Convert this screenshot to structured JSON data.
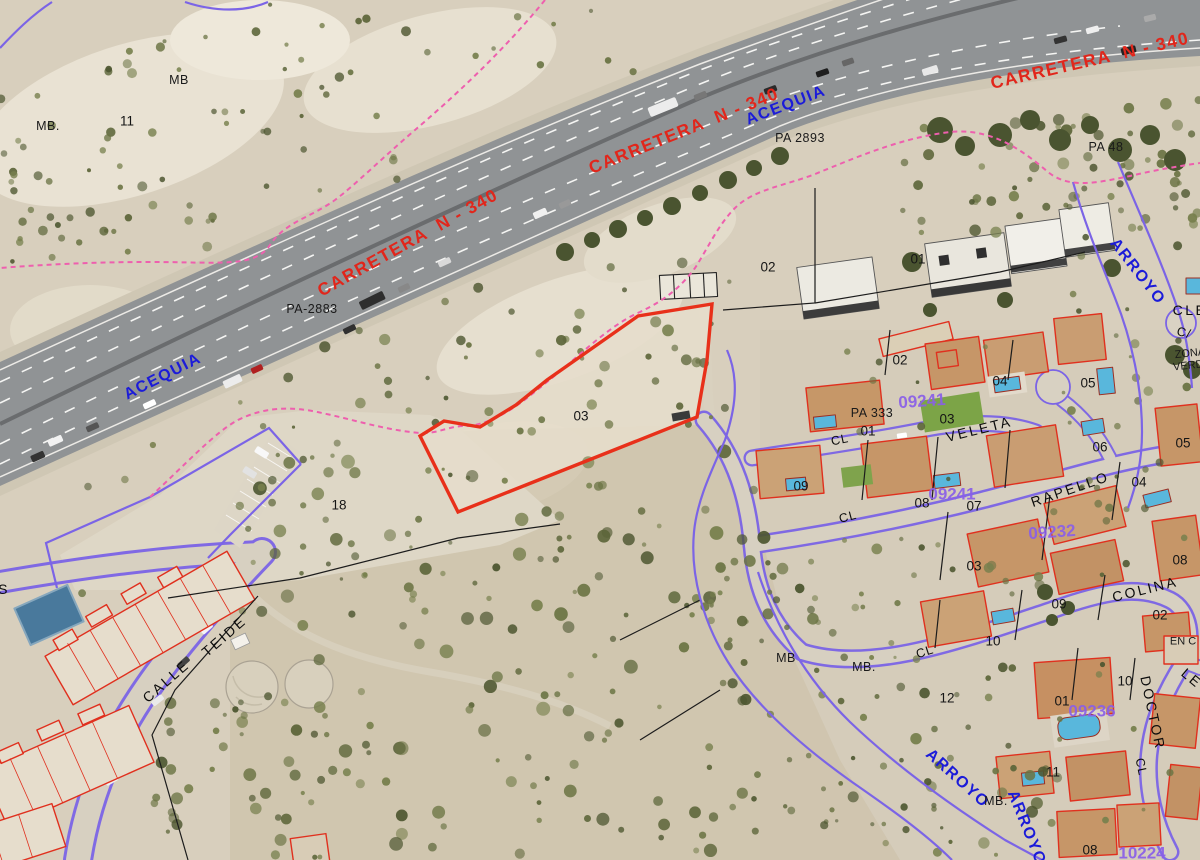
{
  "map": {
    "type": "cadastral-orthophoto",
    "highlighted_parcel": {
      "number": "03",
      "outline_color": "#e8301a"
    },
    "colors": {
      "road_label_red": "#e1261b",
      "hydro_label_blue": "#1b1bd9",
      "block_label_violet": "#8a5fe8",
      "cadastral_building_red": "#e0301e",
      "boundary_purple": "#7b64e6",
      "boundary_pink_dashed": "#ee5fae",
      "pool_blue": "#59b7dc"
    },
    "labels": [
      {
        "text": "CARRETERA  N - 340",
        "x": 408,
        "y": 243,
        "rot": -29,
        "cls": "carretera"
      },
      {
        "text": "CARRETERA  N - 340",
        "x": 684,
        "y": 131,
        "rot": -22,
        "cls": "carretera"
      },
      {
        "text": "CARRETERA  N - 340",
        "x": 1090,
        "y": 61,
        "rot": -13,
        "cls": "carretera"
      },
      {
        "text": "ACEQUIA",
        "x": 163,
        "y": 377,
        "rot": -27,
        "cls": "agua"
      },
      {
        "text": "ACEQUIA",
        "x": 786,
        "y": 106,
        "rot": -21,
        "cls": "agua"
      },
      {
        "text": "ARROYO",
        "x": 1137,
        "y": 272,
        "rot": 52,
        "cls": "agua"
      },
      {
        "text": "ARROYO",
        "x": 957,
        "y": 779,
        "rot": 42,
        "cls": "agua"
      },
      {
        "text": "ARROYO",
        "x": 1026,
        "y": 828,
        "rot": 68,
        "cls": "agua"
      },
      {
        "text": "09241",
        "x": 922,
        "y": 401,
        "rot": -4,
        "cls": "manzana"
      },
      {
        "text": "09241",
        "x": 952,
        "y": 494,
        "rot": 0,
        "cls": "manzana"
      },
      {
        "text": "09232",
        "x": 1052,
        "y": 532,
        "rot": -4,
        "cls": "manzana"
      },
      {
        "text": "09236",
        "x": 1092,
        "y": 711,
        "rot": 0,
        "cls": "manzana"
      },
      {
        "text": "10224",
        "x": 1142,
        "y": 853,
        "rot": 0,
        "cls": "manzana"
      },
      {
        "text": "CALLE",
        "x": 166,
        "y": 681,
        "rot": -41,
        "cls": "street"
      },
      {
        "text": "TEIDE",
        "x": 224,
        "y": 636,
        "rot": -41,
        "cls": "street"
      },
      {
        "text": "VELETA",
        "x": 979,
        "y": 429,
        "rot": -14,
        "cls": "street"
      },
      {
        "text": "RAPELLO",
        "x": 1070,
        "y": 489,
        "rot": -19,
        "cls": "street"
      },
      {
        "text": "COLINA",
        "x": 1145,
        "y": 589,
        "rot": -14,
        "cls": "street"
      },
      {
        "text": "DOCTOR",
        "x": 1153,
        "y": 713,
        "rot": 78,
        "cls": "street"
      },
      {
        "text": "LE",
        "x": 1192,
        "y": 678,
        "rot": 40,
        "cls": "street"
      },
      {
        "text": "CL",
        "x": 840,
        "y": 440,
        "rot": -12,
        "cls": "street-sm"
      },
      {
        "text": "CL",
        "x": 848,
        "y": 517,
        "rot": -15,
        "cls": "street-sm"
      },
      {
        "text": "CL",
        "x": 925,
        "y": 652,
        "rot": -18,
        "cls": "street-sm"
      },
      {
        "text": "CL",
        "x": 1141,
        "y": 767,
        "rot": 78,
        "cls": "street-sm"
      },
      {
        "text": "C/",
        "x": 1184,
        "y": 333,
        "rot": 15,
        "cls": "street-sm"
      },
      {
        "text": "CLE",
        "x": 1190,
        "y": 310,
        "rot": 0,
        "cls": "street"
      },
      {
        "text": "S",
        "x": 4,
        "y": 589,
        "rot": 0,
        "cls": "street"
      },
      {
        "text": "ZONA",
        "x": 1190,
        "y": 354,
        "rot": -6,
        "cls": "small"
      },
      {
        "text": "VERDE",
        "x": 1192,
        "y": 366,
        "rot": -6,
        "cls": "small"
      },
      {
        "text": "EN C",
        "x": 1183,
        "y": 642,
        "rot": 0,
        "cls": "small"
      },
      {
        "text": "PA-2883",
        "x": 312,
        "y": 309,
        "rot": 0,
        "cls": "ref"
      },
      {
        "text": "PA 2893",
        "x": 800,
        "y": 138,
        "rot": 0,
        "cls": "ref"
      },
      {
        "text": "PA 48",
        "x": 1106,
        "y": 147,
        "rot": 0,
        "cls": "ref"
      },
      {
        "text": "PA 333",
        "x": 872,
        "y": 413,
        "rot": 0,
        "cls": "ref"
      },
      {
        "text": "MB.",
        "x": 48,
        "y": 126,
        "rot": 0,
        "cls": "ref"
      },
      {
        "text": "MB",
        "x": 179,
        "y": 80,
        "rot": 0,
        "cls": "ref"
      },
      {
        "text": "MB",
        "x": 786,
        "y": 658,
        "rot": 0,
        "cls": "ref"
      },
      {
        "text": "MB.",
        "x": 864,
        "y": 667,
        "rot": 0,
        "cls": "ref"
      },
      {
        "text": "MB.",
        "x": 996,
        "y": 801,
        "rot": 0,
        "cls": "ref"
      },
      {
        "text": "11",
        "x": 127,
        "y": 121,
        "rot": 0,
        "cls": "num"
      },
      {
        "text": "02",
        "x": 768,
        "y": 267,
        "rot": 0,
        "cls": "num"
      },
      {
        "text": "01",
        "x": 918,
        "y": 259,
        "rot": 0,
        "cls": "num"
      },
      {
        "text": "03",
        "x": 581,
        "y": 416,
        "rot": 0,
        "cls": "num"
      },
      {
        "text": "18",
        "x": 339,
        "y": 505,
        "rot": 0,
        "cls": "num"
      },
      {
        "text": "02",
        "x": 900,
        "y": 360,
        "rot": 0,
        "cls": "num"
      },
      {
        "text": "01",
        "x": 868,
        "y": 431,
        "rot": 0,
        "cls": "num"
      },
      {
        "text": "03",
        "x": 947,
        "y": 419,
        "rot": 0,
        "cls": "num"
      },
      {
        "text": "04",
        "x": 1000,
        "y": 381,
        "rot": 0,
        "cls": "num"
      },
      {
        "text": "05",
        "x": 1088,
        "y": 383,
        "rot": 0,
        "cls": "num"
      },
      {
        "text": "09",
        "x": 801,
        "y": 486,
        "rot": 0,
        "cls": "num"
      },
      {
        "text": "08",
        "x": 922,
        "y": 503,
        "rot": 0,
        "cls": "num"
      },
      {
        "text": "07",
        "x": 974,
        "y": 506,
        "rot": 0,
        "cls": "num"
      },
      {
        "text": "06",
        "x": 1100,
        "y": 447,
        "rot": 0,
        "cls": "num"
      },
      {
        "text": "05",
        "x": 1183,
        "y": 443,
        "rot": 0,
        "cls": "num"
      },
      {
        "text": "04",
        "x": 1139,
        "y": 482,
        "rot": 0,
        "cls": "num"
      },
      {
        "text": "03",
        "x": 974,
        "y": 566,
        "rot": 0,
        "cls": "num"
      },
      {
        "text": "08",
        "x": 1180,
        "y": 560,
        "rot": 0,
        "cls": "num"
      },
      {
        "text": "02",
        "x": 1160,
        "y": 615,
        "rot": 0,
        "cls": "num"
      },
      {
        "text": "09",
        "x": 1059,
        "y": 604,
        "rot": 0,
        "cls": "num"
      },
      {
        "text": "10",
        "x": 993,
        "y": 641,
        "rot": 0,
        "cls": "num"
      },
      {
        "text": "12",
        "x": 947,
        "y": 698,
        "rot": 0,
        "cls": "num"
      },
      {
        "text": "10",
        "x": 1125,
        "y": 681,
        "rot": 0,
        "cls": "num"
      },
      {
        "text": "01",
        "x": 1062,
        "y": 701,
        "rot": 0,
        "cls": "num"
      },
      {
        "text": "11",
        "x": 1053,
        "y": 772,
        "rot": 0,
        "cls": "num"
      },
      {
        "text": "08",
        "x": 1090,
        "y": 850,
        "rot": 0,
        "cls": "num"
      }
    ]
  }
}
